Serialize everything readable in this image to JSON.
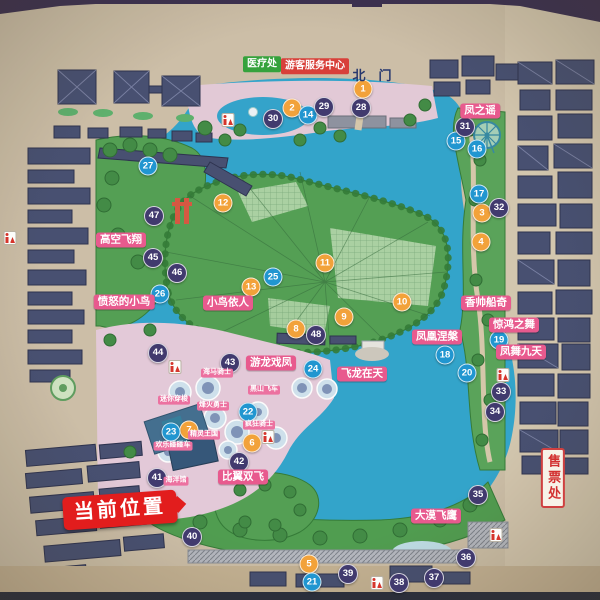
{
  "park_map": {
    "north_gate": {
      "text": "北门"
    },
    "current_location": {
      "text": "当前位置"
    },
    "ticket_office": {
      "text": "售票处"
    },
    "medical_office": {
      "text": "医疗处"
    },
    "visitor_center": {
      "text": "游客服务中心"
    },
    "labels": [
      {
        "text": "医疗处",
        "type": "green-tag",
        "x": 262,
        "y": 64
      },
      {
        "text": "游客服务中心",
        "type": "red-tag",
        "x": 315,
        "y": 66
      },
      {
        "text": "北门",
        "type": "gate",
        "x": 372,
        "y": 76
      },
      {
        "text": "凤之谣",
        "type": "pink",
        "x": 480,
        "y": 111
      },
      {
        "text": "高空飞翔",
        "type": "pink",
        "x": 121,
        "y": 240
      },
      {
        "text": "愤怒的小鸟",
        "type": "pink",
        "x": 124,
        "y": 302
      },
      {
        "text": "小鸟依人",
        "type": "pink",
        "x": 228,
        "y": 303
      },
      {
        "text": "香帅船奇",
        "type": "pink",
        "x": 486,
        "y": 303
      },
      {
        "text": "惊鸿之舞",
        "type": "pink",
        "x": 514,
        "y": 325
      },
      {
        "text": "凤凰涅槃",
        "type": "pink",
        "x": 437,
        "y": 337
      },
      {
        "text": "凤舞九天",
        "type": "pink",
        "x": 521,
        "y": 352
      },
      {
        "text": "游龙戏凤",
        "type": "pink",
        "x": 271,
        "y": 363
      },
      {
        "text": "飞龙在天",
        "type": "pink",
        "x": 362,
        "y": 374
      },
      {
        "text": "比翼双飞",
        "type": "pink",
        "x": 243,
        "y": 477
      },
      {
        "text": "大漠飞鹰",
        "type": "pink",
        "x": 436,
        "y": 516
      },
      {
        "text": "海马骑士",
        "type": "pink-small",
        "x": 217,
        "y": 373
      },
      {
        "text": "黑山飞车",
        "type": "pink-small",
        "x": 264,
        "y": 390
      },
      {
        "text": "迷你穿梭",
        "type": "pink-small",
        "x": 174,
        "y": 400
      },
      {
        "text": "烽火勇士",
        "type": "pink-small",
        "x": 213,
        "y": 406
      },
      {
        "text": "疯狂骑士",
        "type": "pink-small",
        "x": 259,
        "y": 425
      },
      {
        "text": "精灵王国",
        "type": "pink-small",
        "x": 204,
        "y": 435
      },
      {
        "text": "欢乐碰碰车",
        "type": "pink-small",
        "x": 173,
        "y": 446
      },
      {
        "text": "海洋馆",
        "type": "pink-small",
        "x": 176,
        "y": 481
      },
      {
        "text": "当前位置",
        "type": "current",
        "x": 120,
        "y": 510
      },
      {
        "text": "售票处",
        "type": "ticket",
        "x": 553,
        "y": 478
      }
    ],
    "markers": [
      {
        "n": 1,
        "c": "orange",
        "x": 363,
        "y": 89
      },
      {
        "n": 2,
        "c": "orange",
        "x": 292,
        "y": 108
      },
      {
        "n": 3,
        "c": "orange",
        "x": 482,
        "y": 213
      },
      {
        "n": 4,
        "c": "orange",
        "x": 481,
        "y": 242
      },
      {
        "n": 5,
        "c": "orange",
        "x": 309,
        "y": 564
      },
      {
        "n": 6,
        "c": "orange",
        "x": 252,
        "y": 443
      },
      {
        "n": 7,
        "c": "orange",
        "x": 189,
        "y": 430
      },
      {
        "n": 8,
        "c": "orange",
        "x": 296,
        "y": 329
      },
      {
        "n": 9,
        "c": "orange",
        "x": 344,
        "y": 317
      },
      {
        "n": 10,
        "c": "orange",
        "x": 402,
        "y": 302
      },
      {
        "n": 11,
        "c": "orange",
        "x": 325,
        "y": 263
      },
      {
        "n": 12,
        "c": "orange",
        "x": 223,
        "y": 203
      },
      {
        "n": 13,
        "c": "orange",
        "x": 251,
        "y": 287
      },
      {
        "n": 14,
        "c": "blue",
        "x": 308,
        "y": 115
      },
      {
        "n": 15,
        "c": "blue",
        "x": 456,
        "y": 141
      },
      {
        "n": 16,
        "c": "blue",
        "x": 477,
        "y": 149
      },
      {
        "n": 17,
        "c": "blue",
        "x": 479,
        "y": 194
      },
      {
        "n": 18,
        "c": "blue",
        "x": 445,
        "y": 355
      },
      {
        "n": 19,
        "c": "blue",
        "x": 499,
        "y": 340
      },
      {
        "n": 20,
        "c": "blue",
        "x": 467,
        "y": 373
      },
      {
        "n": 21,
        "c": "blue",
        "x": 312,
        "y": 582
      },
      {
        "n": 22,
        "c": "blue",
        "x": 248,
        "y": 412
      },
      {
        "n": 23,
        "c": "blue",
        "x": 171,
        "y": 432
      },
      {
        "n": 24,
        "c": "blue",
        "x": 313,
        "y": 369
      },
      {
        "n": 25,
        "c": "blue",
        "x": 273,
        "y": 277
      },
      {
        "n": 26,
        "c": "blue",
        "x": 160,
        "y": 294
      },
      {
        "n": 27,
        "c": "blue",
        "x": 148,
        "y": 166
      },
      {
        "n": 28,
        "c": "navy",
        "x": 361,
        "y": 108
      },
      {
        "n": 29,
        "c": "navy",
        "x": 324,
        "y": 107
      },
      {
        "n": 30,
        "c": "navy",
        "x": 273,
        "y": 119
      },
      {
        "n": 31,
        "c": "navy",
        "x": 465,
        "y": 127
      },
      {
        "n": 32,
        "c": "navy",
        "x": 499,
        "y": 208
      },
      {
        "n": 33,
        "c": "navy",
        "x": 501,
        "y": 392
      },
      {
        "n": 34,
        "c": "navy",
        "x": 495,
        "y": 412
      },
      {
        "n": 35,
        "c": "navy",
        "x": 478,
        "y": 495
      },
      {
        "n": 36,
        "c": "navy",
        "x": 466,
        "y": 558
      },
      {
        "n": 37,
        "c": "navy",
        "x": 434,
        "y": 578
      },
      {
        "n": 38,
        "c": "navy",
        "x": 399,
        "y": 583
      },
      {
        "n": 39,
        "c": "navy",
        "x": 348,
        "y": 574
      },
      {
        "n": 40,
        "c": "navy",
        "x": 192,
        "y": 537
      },
      {
        "n": 41,
        "c": "navy",
        "x": 157,
        "y": 478
      },
      {
        "n": 42,
        "c": "navy",
        "x": 239,
        "y": 462
      },
      {
        "n": 43,
        "c": "navy",
        "x": 230,
        "y": 363
      },
      {
        "n": 44,
        "c": "navy",
        "x": 158,
        "y": 353
      },
      {
        "n": 45,
        "c": "navy",
        "x": 153,
        "y": 258
      },
      {
        "n": 46,
        "c": "navy",
        "x": 177,
        "y": 273
      },
      {
        "n": 47,
        "c": "navy",
        "x": 154,
        "y": 216
      },
      {
        "n": 48,
        "c": "navy",
        "x": 316,
        "y": 335
      }
    ],
    "icons": {
      "restrooms": [
        {
          "x": 228,
          "y": 120
        },
        {
          "x": 175,
          "y": 367
        },
        {
          "x": 268,
          "y": 437
        },
        {
          "x": 503,
          "y": 375
        },
        {
          "x": 496,
          "y": 535
        },
        {
          "x": 377,
          "y": 583
        },
        {
          "x": 10,
          "y": 238
        }
      ],
      "ferris_wheel": {
        "x": 487,
        "y": 135
      }
    },
    "colors": {
      "marker_orange": "#f2a23a",
      "marker_blue": "#2196d0",
      "marker_navy": "#413a6e",
      "label_pink": "#e85a8e",
      "current_red": "#e21d1d",
      "lake_blue": "#28a7d2",
      "island_green": "#4ea24e",
      "paper_beige": "#cfc0a6"
    }
  }
}
